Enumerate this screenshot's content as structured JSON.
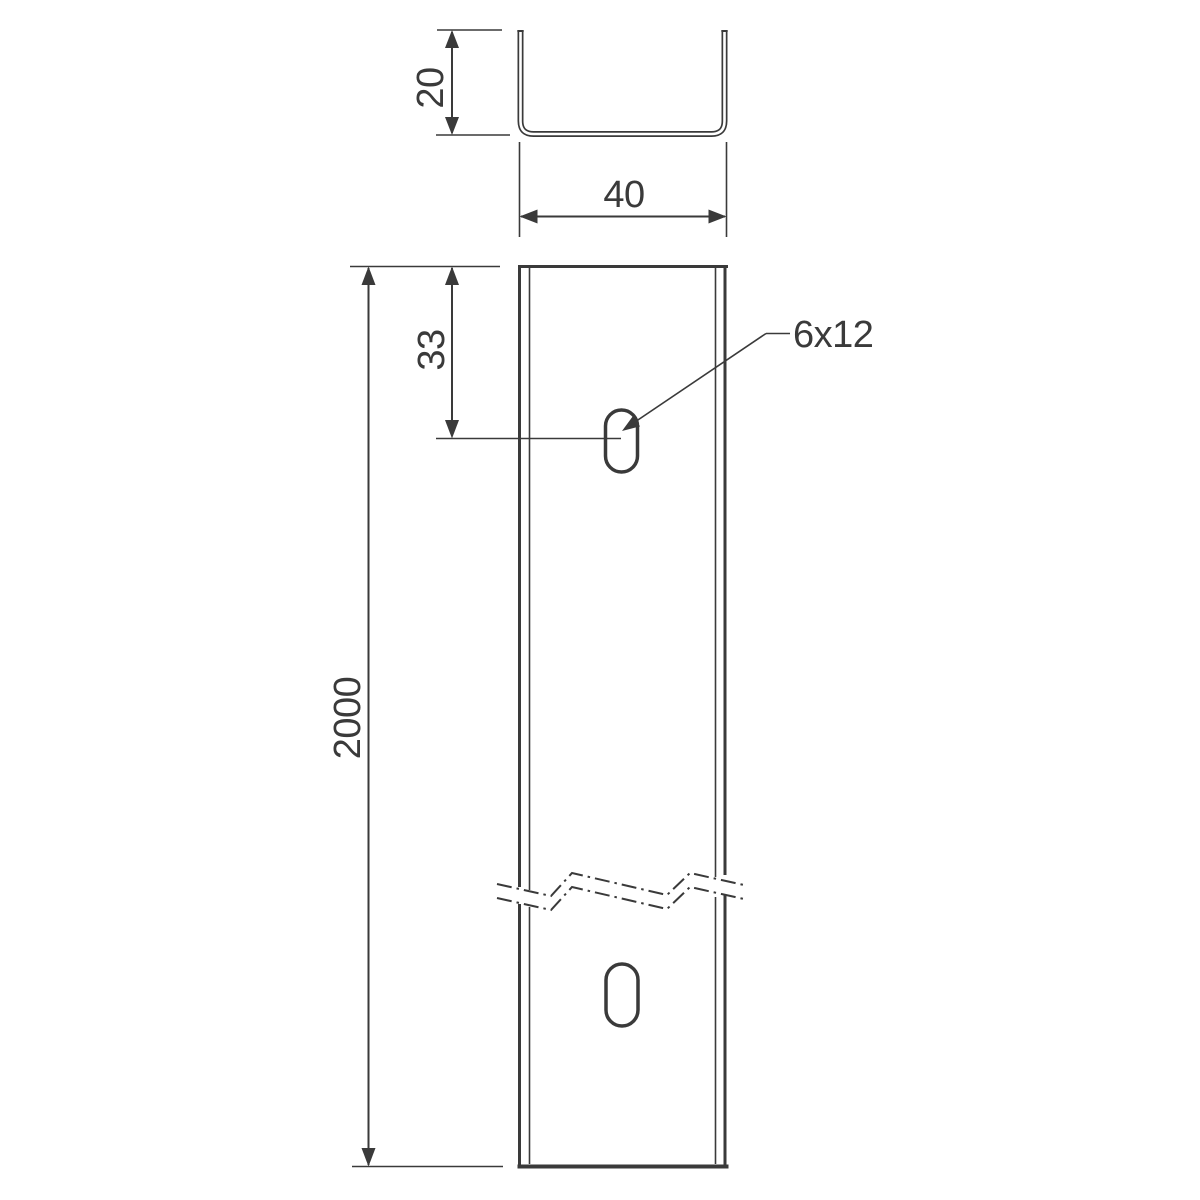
{
  "drawing": {
    "line_color": "#3a3a3a",
    "background_color": "#ffffff",
    "dimensions": {
      "profile_height": "20",
      "profile_width": "40",
      "total_length": "2000",
      "slot_offset_from_end": "33",
      "slot_size": "6x12"
    }
  }
}
